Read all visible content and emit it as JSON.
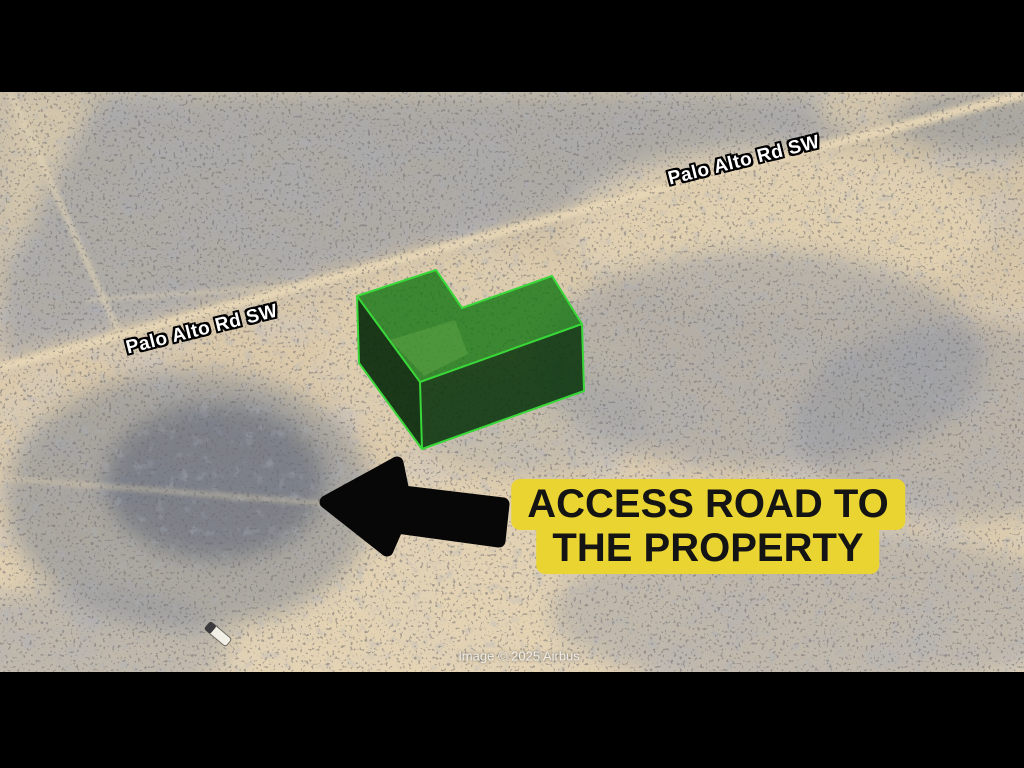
{
  "map": {
    "road_labels": [
      {
        "text": "Palo Alto Rd SW"
      },
      {
        "text": "Palo Alto Rd SW"
      }
    ],
    "callout": {
      "line1": "ACCESS ROAD TO",
      "line2": "THE PROPERTY",
      "highlight_color": "#e9d431",
      "text_color": "#141414"
    },
    "attribution": "Image © 2025 Airbus",
    "property_marker": {
      "label": "L-shaped parcel outline (3D extruded)",
      "top_color": "#1f7d1e",
      "side_color": "#0a3a0c",
      "outline_color": "#38d838"
    },
    "arrow_color": "#070707",
    "terrain": {
      "sand_color": "#dccaa9",
      "scrub_color": "#8b92a0",
      "road_color": "#ead9b8"
    },
    "letterbox_color": "#000000"
  }
}
